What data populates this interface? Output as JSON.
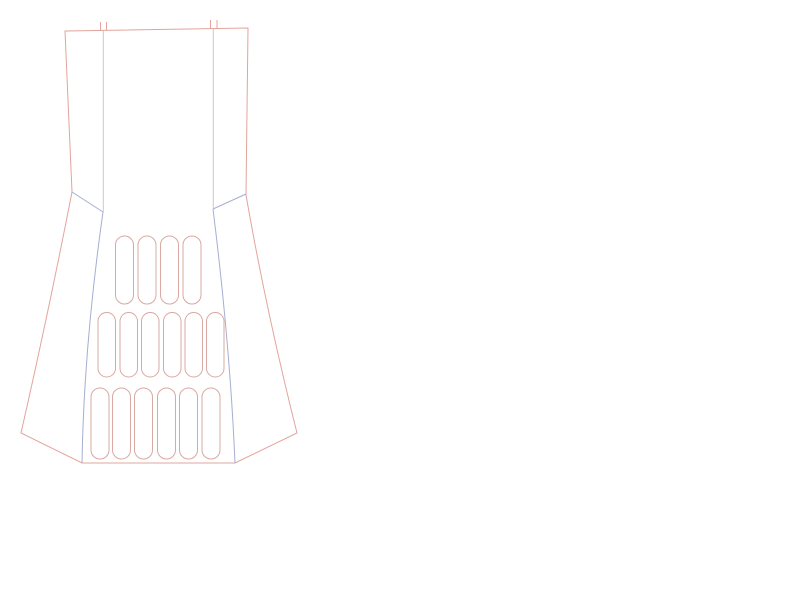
{
  "canvas": {
    "width": 800,
    "height": 600,
    "background": "#ffffff"
  },
  "palette": {
    "outline": "#e2a49c",
    "seam": "#a6aed2",
    "guide": "#c6c9d4",
    "slot": "#d9a8a2"
  },
  "paths": [
    {
      "name": "outer-outline",
      "stroke": "outline",
      "d": "M 65,31 L 248,28 L 246,195 Q 266,310 297,433 L 235,463 L 82,463 L 21,433 Q 49,310 72,192 Z"
    },
    {
      "name": "inner-guide-left",
      "stroke": "guide",
      "d": "M 103.3,31 L 103.3,212"
    },
    {
      "name": "inner-guide-right",
      "stroke": "guide",
      "d": "M 213.3,29 L 213.3,209"
    },
    {
      "name": "shoulder-seam-left",
      "stroke": "seam",
      "d": "M 72,192 L 103,212"
    },
    {
      "name": "shoulder-seam-right",
      "stroke": "seam",
      "d": "M 246,194 L 213,209"
    },
    {
      "name": "panel-seam-left",
      "stroke": "seam",
      "d": "M 103,212 Q 84,345 82,463"
    },
    {
      "name": "panel-seam-right",
      "stroke": "seam",
      "d": "M 213,209 Q 230,345 235,463"
    },
    {
      "name": "notch-tick-1",
      "stroke": "outline",
      "d": "M 100.5,22 L 100.5,30.5"
    },
    {
      "name": "notch-tick-2",
      "stroke": "outline",
      "d": "M 106.5,22 L 106.5,30.5"
    },
    {
      "name": "notch-tick-3",
      "stroke": "outline",
      "d": "M 210.5,20 L 210.5,28.5"
    },
    {
      "name": "notch-tick-4",
      "stroke": "outline",
      "d": "M 217,20 L 217,28.5"
    }
  ],
  "slot_rows": [
    {
      "name": "slot-row-top",
      "y": 236,
      "height": 68,
      "width": 18,
      "radius": 9,
      "x_positions": [
        115.5,
        138,
        160.5,
        183
      ]
    },
    {
      "name": "slot-row-middle",
      "y": 312.5,
      "height": 64.5,
      "width": 17.5,
      "radius": 8.75,
      "x_positions": [
        98,
        120,
        141.5,
        163.5,
        185,
        206.5
      ]
    },
    {
      "name": "slot-row-bottom",
      "y": 388,
      "height": 71,
      "width": 18,
      "radius": 9,
      "x_positions": [
        91,
        112.5,
        134.5,
        157.5,
        179.5,
        202
      ]
    }
  ]
}
